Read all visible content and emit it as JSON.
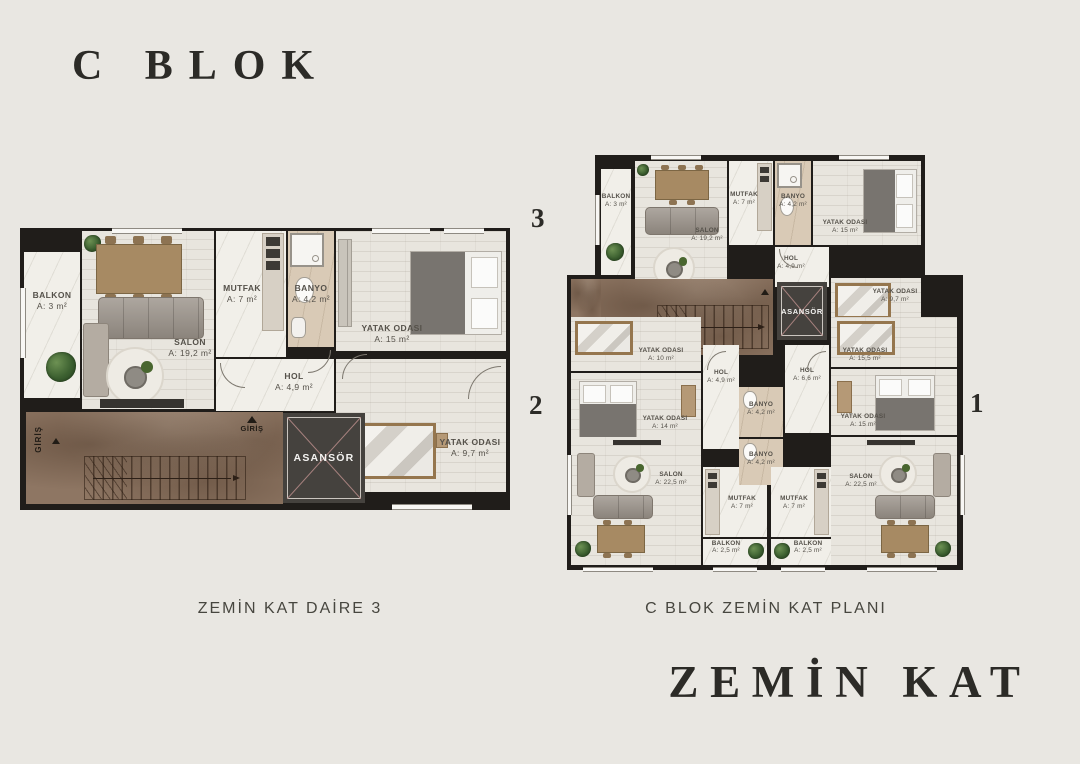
{
  "titles": {
    "block": "C BLOK",
    "floor": "ZEMİN KAT"
  },
  "captions": {
    "left": "ZEMİN KAT DAİRE 3",
    "right": "C BLOK ZEMİN KAT PLANI"
  },
  "numbers": {
    "unit3": "3",
    "unit2": "2",
    "unit1": "1"
  },
  "daire3": {
    "balkon": {
      "name": "BALKON",
      "area": "A: 3 m²"
    },
    "salon": {
      "name": "SALON",
      "area": "A: 19,2 m²"
    },
    "mutfak": {
      "name": "MUTFAK",
      "area": "A: 7 m²"
    },
    "banyo": {
      "name": "BANYO",
      "area": "A: 4,2 m²"
    },
    "yatak_odasi_1": {
      "name": "YATAK ODASI",
      "area": "A: 15 m²"
    },
    "hol": {
      "name": "HOL",
      "area": "A: 4,9 m²"
    },
    "yatak_odasi_2": {
      "name": "YATAK ODASI",
      "area": "A: 9,7 m²"
    },
    "asansor": {
      "name": "ASANSÖR"
    },
    "giris_left": "GİRİŞ",
    "giris_right": "GİRİŞ"
  },
  "floor_plan": {
    "asansor": {
      "name": "ASANSÖR"
    },
    "unit3": {
      "balkon": {
        "name": "BALKON",
        "area": "A: 3 m²"
      },
      "salon": {
        "name": "SALON",
        "area": "A: 19,2 m²"
      },
      "mutfak": {
        "name": "MUTFAK",
        "area": "A: 7 m²"
      },
      "banyo": {
        "name": "BANYO",
        "area": "A: 4,2 m²"
      },
      "yatak_odasi_1": {
        "name": "YATAK ODASI",
        "area": "A: 15 m²"
      },
      "hol": {
        "name": "HOL",
        "area": "A: 4,9 m²"
      },
      "yatak_odasi_2": {
        "name": "YATAK ODASI",
        "area": "A: 9,7 m²"
      }
    },
    "unit2": {
      "yatak_odasi_1": {
        "name": "YATAK ODASI",
        "area": "A: 10 m²"
      },
      "yatak_odasi_2": {
        "name": "YATAK ODASI",
        "area": "A: 14 m²"
      },
      "hol": {
        "name": "HOL",
        "area": "A: 4,9 m²"
      },
      "banyo": {
        "name": "BANYO",
        "area": "A: 4,2 m²"
      },
      "salon": {
        "name": "SALON",
        "area": "A: 22,5 m²"
      },
      "mutfak": {
        "name": "MUTFAK",
        "area": "A: 7 m²"
      },
      "balkon": {
        "name": "BALKON",
        "area": "A: 2,5 m²"
      }
    },
    "unit1": {
      "yatak_odasi_1": {
        "name": "YATAK ODASI",
        "area": "A: 15,5 m²"
      },
      "yatak_odasi_2": {
        "name": "YATAK ODASI",
        "area": "A: 15 m²"
      },
      "hol": {
        "name": "HOL",
        "area": "A: 6,6 m²"
      },
      "banyo": {
        "name": "BANYO",
        "area": "A: 4,2 m²"
      },
      "salon": {
        "name": "SALON",
        "area": "A: 22,5 m²"
      },
      "mutfak": {
        "name": "MUTFAK",
        "area": "A: 7 m²"
      },
      "balkon": {
        "name": "BALKON",
        "area": "A: 2,5 m²"
      }
    }
  },
  "colors": {
    "background": "#e9e7e2",
    "wall": "#201d1a",
    "title_text": "#2c2b27",
    "caption_text": "#47463f",
    "corridor_brown": "#8e7663",
    "elevator_box": "#45423e",
    "elevator_cross": "#a8827f"
  }
}
